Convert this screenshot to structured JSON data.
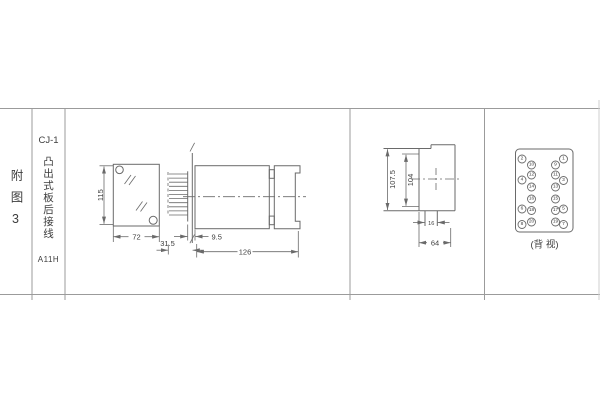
{
  "figure": {
    "label": "附图3"
  },
  "product": {
    "model": "CJ-1",
    "title": "凸出式板后接线",
    "code": "A11H"
  },
  "views": {
    "front": {
      "height": "115",
      "width": "72"
    },
    "side": {
      "pin_len": "31.5",
      "panel": "9.5",
      "length": "126"
    },
    "outline": {
      "overall": "107.5",
      "inner": "104",
      "tab": "16",
      "width": "64"
    },
    "back": {
      "caption": "(背 视)",
      "terminals": [
        "2",
        "1",
        "10",
        "9",
        "12",
        "11",
        "4",
        "3",
        "14",
        "13",
        "16",
        "15",
        "6",
        "5",
        "18",
        "17",
        "20",
        "19",
        "8",
        "7"
      ]
    }
  },
  "colors": {
    "line": "#6a6a6a",
    "text": "#3d3d3d",
    "border": "#9b9b9b"
  }
}
